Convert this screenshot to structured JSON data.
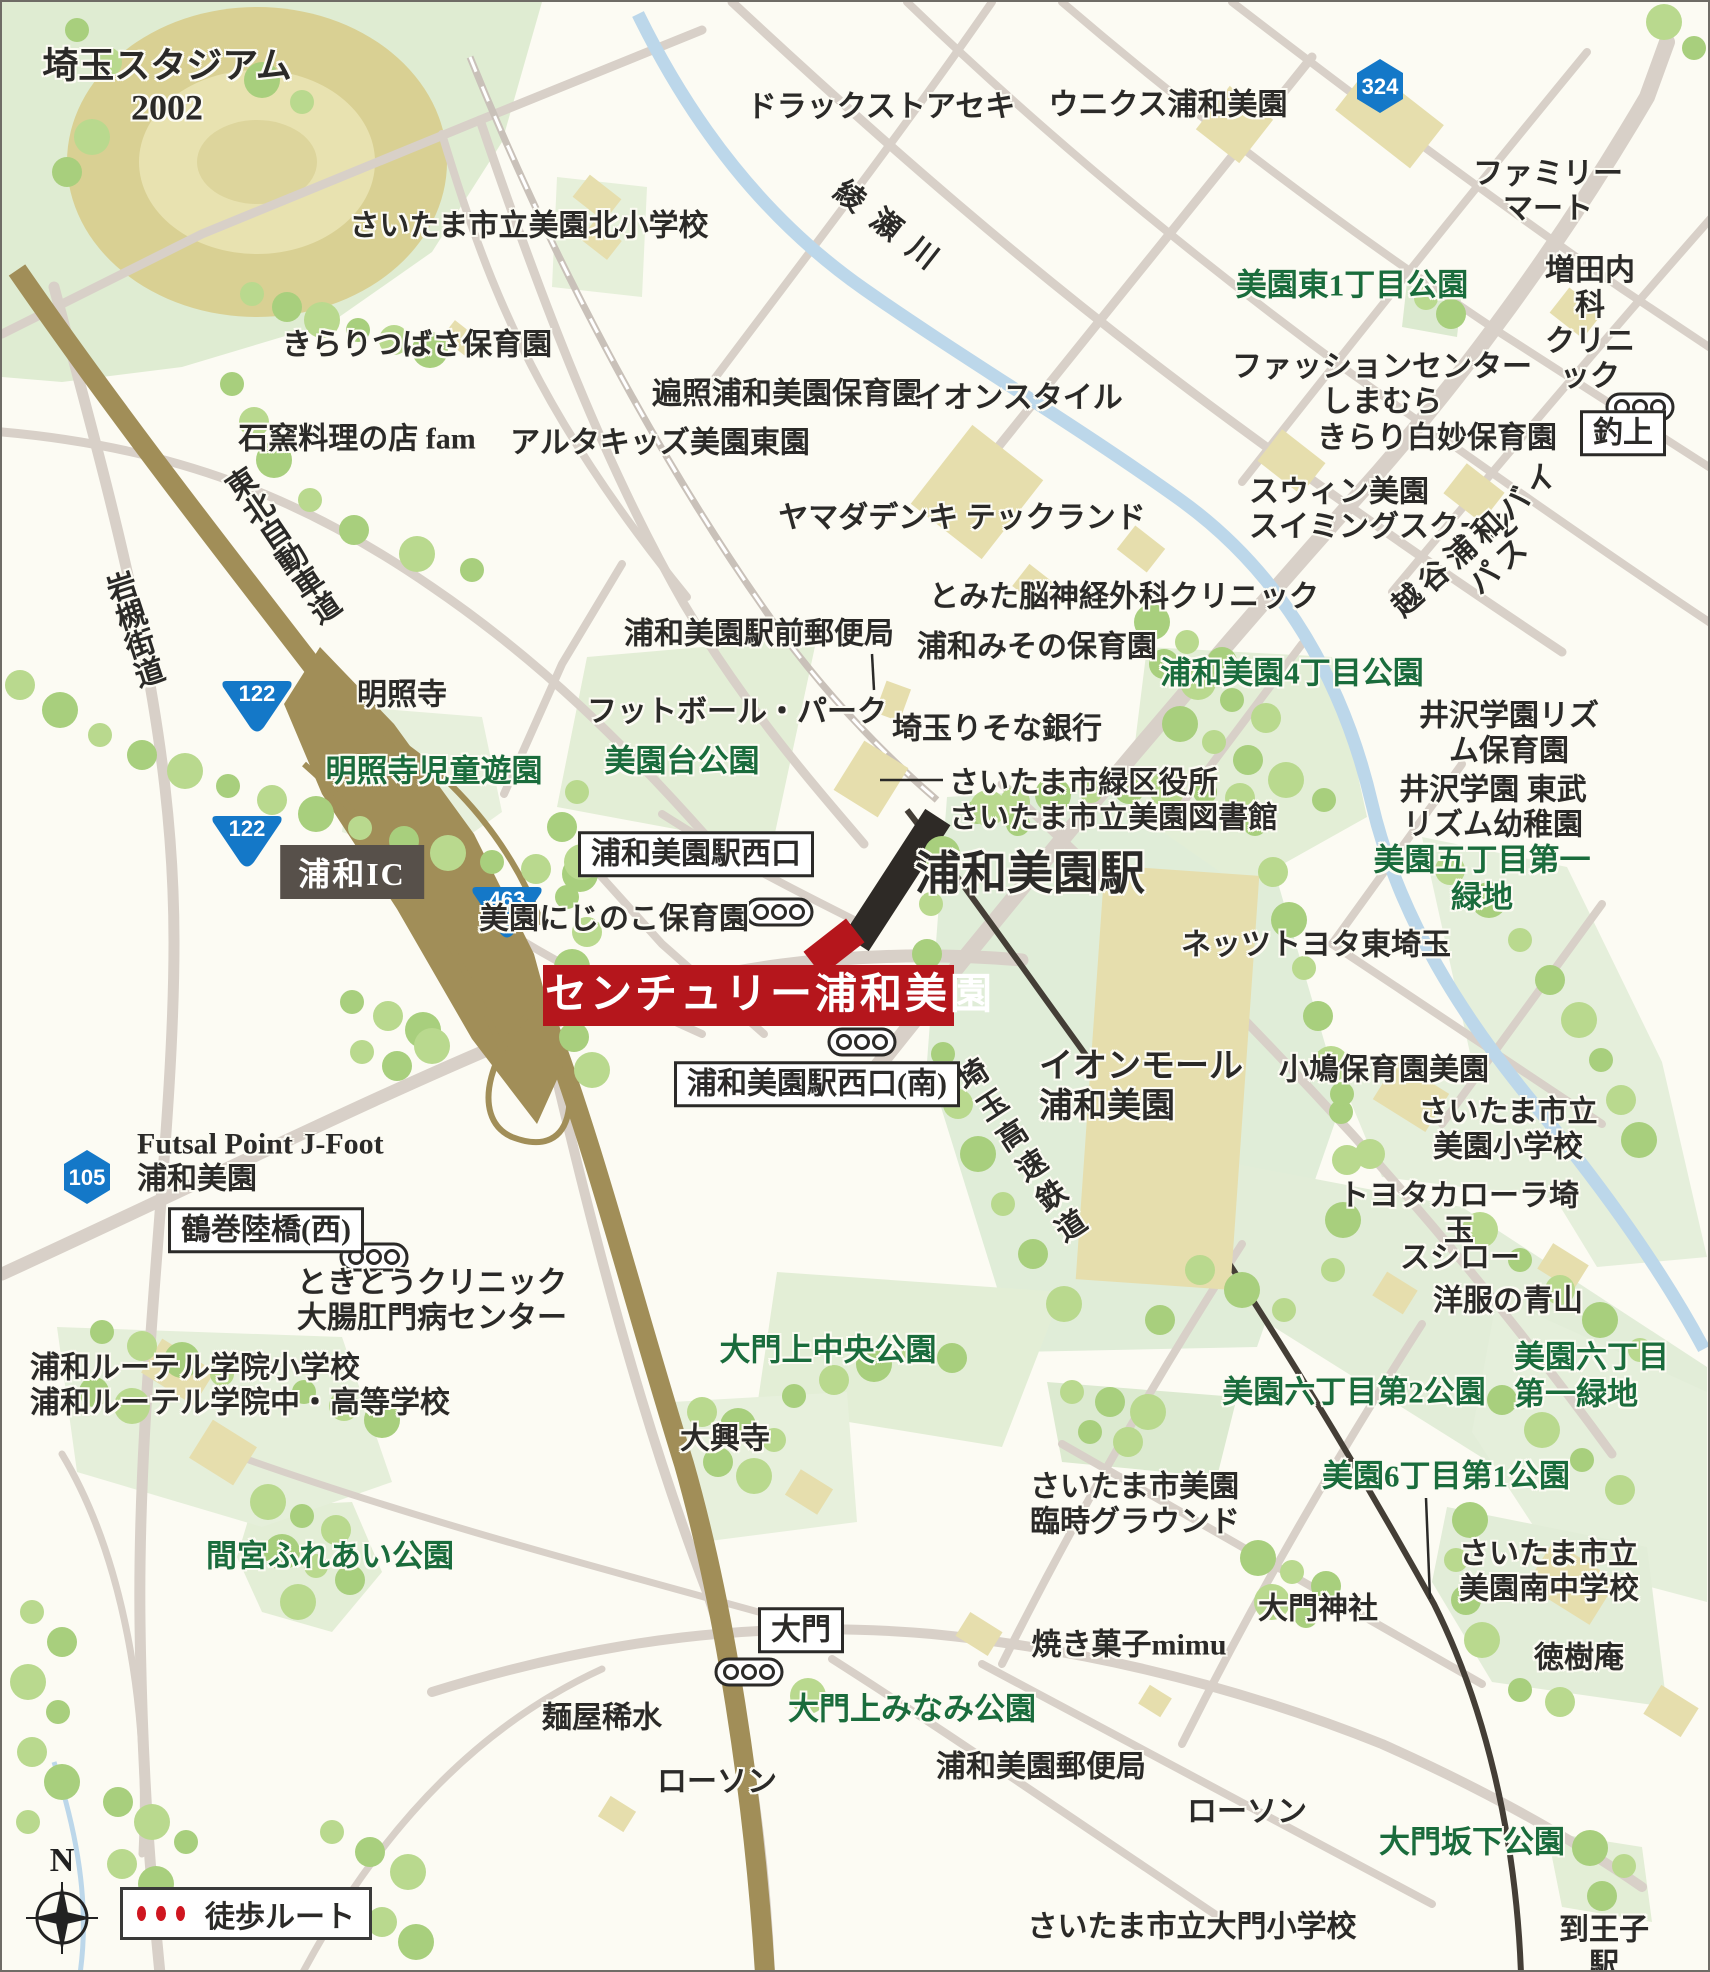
{
  "colors": {
    "accent_red": "#b5161c",
    "park_text_green": "#1a6c3c",
    "shield_blue": "#1478c8",
    "expressway_olive": "#a18e58",
    "river_blue": "#bcd7ea",
    "road_gray": "#d8d0c8",
    "rail_dark": "#443e36"
  },
  "legend": {
    "walk_route": "徒歩ルート",
    "north": "N"
  },
  "property": {
    "banner_label": "センチュリー浦和美園"
  },
  "map": {
    "signposts": [
      {
        "name": "sign-urawamisono-west-exit",
        "text": "浦和美園駅西口",
        "x": 694,
        "y": 852
      },
      {
        "name": "sign-urawamisono-west-exit-south",
        "text": "浦和美園駅西口(南)",
        "x": 815,
        "y": 1082
      },
      {
        "name": "sign-tsurumaki-bridge-west",
        "text": "鶴巻陸橋(西)",
        "x": 264,
        "y": 1228
      },
      {
        "name": "sign-daimon",
        "text": "大門",
        "x": 799,
        "y": 1628
      },
      {
        "name": "sign-tsuriage",
        "text": "釣上",
        "x": 1621,
        "y": 431
      }
    ],
    "ic_label": {
      "text": "浦和IC",
      "x": 350,
      "y": 870
    },
    "route_shields": [
      {
        "num": "122",
        "type": "tri",
        "x": 255,
        "y": 700
      },
      {
        "num": "122",
        "type": "tri",
        "x": 245,
        "y": 835
      },
      {
        "num": "463",
        "type": "tri",
        "x": 505,
        "y": 906
      },
      {
        "num": "324",
        "type": "hex",
        "x": 1378,
        "y": 84
      },
      {
        "num": "105",
        "type": "hex",
        "x": 85,
        "y": 1175
      }
    ],
    "bus_stops": [
      [
        777,
        910
      ],
      [
        860,
        1040
      ],
      [
        1638,
        405
      ],
      [
        372,
        1255
      ],
      [
        747,
        1670
      ]
    ],
    "pointer_lines": [
      [
        870,
        652,
        872,
        688
      ],
      [
        878,
        778,
        941,
        778
      ],
      [
        1424,
        1496,
        1428,
        1597
      ]
    ],
    "labels": [
      {
        "name": "saitama-stadium",
        "text": "埼玉スタジアム\n2002",
        "x": 165,
        "y": 85,
        "s": 36,
        "w": 700
      },
      {
        "name": "misono-kita-elementary",
        "text": "さいたま市立美園北小学校",
        "x": 527,
        "y": 224,
        "s": 30
      },
      {
        "name": "kirari-tsubasa-nursery",
        "text": "きらりつばさ保育園",
        "x": 415,
        "y": 343,
        "s": 30
      },
      {
        "name": "ishigama-fam",
        "text": "石窯料理の店 fam",
        "x": 355,
        "y": 437,
        "s": 30
      },
      {
        "name": "altakids-misono-higashi",
        "text": "アルタキッズ美園東園",
        "x": 658,
        "y": 441,
        "s": 30
      },
      {
        "name": "henjo-urawamisono-nursery",
        "text": "遍照浦和美園保育園",
        "x": 785,
        "y": 392,
        "s": 30
      },
      {
        "name": "drugstore-seki",
        "text": "ドラックストアセキ",
        "x": 879,
        "y": 105,
        "s": 30
      },
      {
        "name": "unicus-urawamisono",
        "text": "ウニクス浦和美園",
        "x": 1166,
        "y": 103,
        "s": 30
      },
      {
        "name": "ayase-river",
        "text": "綾瀬川",
        "x": 890,
        "y": 228,
        "s": 30,
        "rot": 38,
        "spacing": 16
      },
      {
        "name": "familymart",
        "text": "ファミリーマート",
        "x": 1546,
        "y": 190,
        "s": 30
      },
      {
        "name": "misono-higashi-1chome-park",
        "text": "美園東1丁目公園",
        "x": 1350,
        "y": 284,
        "s": 31,
        "c": "green"
      },
      {
        "name": "masuda-naika-clinic",
        "text": "増田内科\nクリニック",
        "x": 1588,
        "y": 322,
        "s": 30
      },
      {
        "name": "fashioncenter-shimamura",
        "text": "ファッションセンターしまむら",
        "x": 1380,
        "y": 383,
        "s": 30
      },
      {
        "name": "kirari-shirotae-nursery",
        "text": "きらり白妙保育園",
        "x": 1435,
        "y": 436,
        "s": 30
      },
      {
        "name": "swin-misono-swimming",
        "text": "スウィン美園\nスイミングスクール",
        "x": 1247,
        "y": 508,
        "s": 30,
        "align": "left"
      },
      {
        "name": "koshigaya-urawa-bypass",
        "text": "越谷浦和バイパス",
        "x": 1487,
        "y": 550,
        "s": 30,
        "rot": -42,
        "spacing": 6
      },
      {
        "name": "yamada-denki-techland",
        "text": "ヤマダデンキ テックランド",
        "x": 960,
        "y": 516,
        "s": 30
      },
      {
        "name": "tomita-neurosurgery-clinic",
        "text": "とみた脳神経外科クリニック",
        "x": 1122,
        "y": 595,
        "s": 30
      },
      {
        "name": "ekimae-post-office",
        "text": "浦和美園駅前郵便局",
        "x": 757,
        "y": 632,
        "s": 30
      },
      {
        "name": "urawa-misono-nursery",
        "text": "浦和みその保育園",
        "x": 1035,
        "y": 645,
        "s": 30
      },
      {
        "name": "urawamisono-4chome-park",
        "text": "浦和美園4丁目公園",
        "x": 1290,
        "y": 672,
        "s": 31,
        "c": "green"
      },
      {
        "name": "izawa-gakuen-rhythm-nursery",
        "text": "井沢学園リズム保育園",
        "x": 1507,
        "y": 732,
        "s": 30
      },
      {
        "name": "izawa-gakuen-tobu-rhythm-kindergarten",
        "text": "井沢学園 東武リズム幼稚園",
        "x": 1491,
        "y": 806,
        "s": 30
      },
      {
        "name": "meishoji-temple",
        "text": "明照寺",
        "x": 400,
        "y": 693,
        "s": 30
      },
      {
        "name": "meishoji-jido-yuen",
        "text": "明照寺児童遊園",
        "x": 432,
        "y": 770,
        "s": 31,
        "c": "green"
      },
      {
        "name": "football-park",
        "text": "フットボール・パーク",
        "x": 735,
        "y": 710,
        "s": 30
      },
      {
        "name": "misonodai-park",
        "text": "美園台公園",
        "x": 680,
        "y": 760,
        "s": 31,
        "c": "green"
      },
      {
        "name": "saitama-resona-bank",
        "text": "埼玉りそな銀行",
        "x": 995,
        "y": 727,
        "s": 30
      },
      {
        "name": "midori-ward-office-library",
        "text": "さいたま市緑区役所\nさいたま市立美園図書館",
        "x": 947,
        "y": 799,
        "s": 30,
        "align": "left"
      },
      {
        "name": "urawa-misono-station",
        "text": "浦和美園駅",
        "x": 1028,
        "y": 872,
        "s": 46,
        "w": 700
      },
      {
        "name": "misono-5chome-ryokuchi",
        "text": "美園五丁目第一緑地",
        "x": 1480,
        "y": 877,
        "s": 31,
        "c": "green"
      },
      {
        "name": "netz-toyota-higashisaitama",
        "text": "ネッツトヨタ東埼玉",
        "x": 1314,
        "y": 943,
        "s": 30
      },
      {
        "name": "misono-nijinoko-nursery",
        "text": "美園にじのこ保育園",
        "x": 612,
        "y": 917,
        "s": 30
      },
      {
        "name": "aeon-mall-urawamisono",
        "text": "イオンモール\n浦和美園",
        "x": 1037,
        "y": 1085,
        "s": 34,
        "align": "left"
      },
      {
        "name": "kobato-nursery-misono",
        "text": "小鳩保育園美園",
        "x": 1382,
        "y": 1068,
        "s": 30
      },
      {
        "name": "misono-elementary",
        "text": "さいたま市立美園小学校",
        "x": 1506,
        "y": 1128,
        "s": 30
      },
      {
        "name": "toyota-corolla-saitama",
        "text": "トヨタカローラ埼玉",
        "x": 1457,
        "y": 1212,
        "s": 30
      },
      {
        "name": "sushiro",
        "text": "スシロー",
        "x": 1458,
        "y": 1256,
        "s": 30
      },
      {
        "name": "yofuku-no-aoyama",
        "text": "洋服の青山",
        "x": 1506,
        "y": 1299,
        "s": 30
      },
      {
        "name": "misono-6chome-daiichi-ryokuchi",
        "text": "美園六丁目\n第一緑地",
        "x": 1512,
        "y": 1374,
        "s": 31,
        "c": "green",
        "align": "left"
      },
      {
        "name": "misono-6chome-dai2-park",
        "text": "美園六丁目第2公園",
        "x": 1352,
        "y": 1391,
        "s": 31,
        "c": "green"
      },
      {
        "name": "misono-6chome-dai1-park",
        "text": "美園6丁目第1公園",
        "x": 1444,
        "y": 1475,
        "s": 31,
        "c": "green"
      },
      {
        "name": "misono-minami-junior-high",
        "text": "さいたま市立\n美園南中学校",
        "x": 1457,
        "y": 1570,
        "s": 30,
        "align": "left"
      },
      {
        "name": "daimon-shrine",
        "text": "大門神社",
        "x": 1316,
        "y": 1607,
        "s": 30
      },
      {
        "name": "tokujuan",
        "text": "徳樹庵",
        "x": 1577,
        "y": 1656,
        "s": 30
      },
      {
        "name": "daimon-sakashita-park",
        "text": "大門坂下公園",
        "x": 1470,
        "y": 1841,
        "s": 31,
        "c": "green"
      },
      {
        "name": "to-oji-station",
        "text": "到王子駅",
        "x": 1602,
        "y": 1946,
        "s": 30
      },
      {
        "name": "daimon-elementary",
        "text": "さいたま市立大門小学校",
        "x": 1190,
        "y": 1925,
        "s": 30
      },
      {
        "name": "lawson-east",
        "text": "ローソン",
        "x": 1245,
        "y": 1810,
        "s": 30
      },
      {
        "name": "urawamisono-post-office",
        "text": "浦和美園郵便局",
        "x": 1039,
        "y": 1765,
        "s": 30
      },
      {
        "name": "yakigashi-mimu",
        "text": "焼き菓子mimu",
        "x": 1127,
        "y": 1643,
        "s": 30
      },
      {
        "name": "misono-rinji-ground",
        "text": "さいたま市美園\n臨時グラウンド",
        "x": 1028,
        "y": 1503,
        "s": 30,
        "align": "left"
      },
      {
        "name": "daimonkami-minami-park",
        "text": "大門上みなみ公園",
        "x": 910,
        "y": 1708,
        "s": 31,
        "c": "green"
      },
      {
        "name": "lawson-west",
        "text": "ローソン",
        "x": 715,
        "y": 1780,
        "s": 30
      },
      {
        "name": "menya-kisui",
        "text": "麺屋稀水",
        "x": 600,
        "y": 1716,
        "s": 30
      },
      {
        "name": "daikoji-temple",
        "text": "大興寺",
        "x": 723,
        "y": 1437,
        "s": 30
      },
      {
        "name": "daimonkami-chuo-park",
        "text": "大門上中央公園",
        "x": 826,
        "y": 1349,
        "s": 31,
        "c": "green"
      },
      {
        "name": "mamiya-fureai-park",
        "text": "間宮ふれあい公園",
        "x": 328,
        "y": 1555,
        "s": 31,
        "c": "green"
      },
      {
        "name": "urawa-lutheran-schools",
        "text": "浦和ルーテル学院小学校\n浦和ルーテル学院中・高等学校",
        "x": 28,
        "y": 1384,
        "s": 30,
        "align": "left"
      },
      {
        "name": "tokito-clinic",
        "text": "ときとうクリニック\n大腸肛門病センター",
        "x": 295,
        "y": 1299,
        "s": 30,
        "align": "left"
      },
      {
        "name": "futsal-point-jfoot",
        "text": "Futsal Point J-Foot\n浦和美園",
        "x": 135,
        "y": 1160,
        "s": 30,
        "align": "left"
      },
      {
        "name": "tohoku-expressway",
        "text": "東北自動車道",
        "x": 278,
        "y": 545,
        "s": 30,
        "rot": -34,
        "vertical": true
      },
      {
        "name": "iwatsuki-kaido",
        "text": "岩槻街道",
        "x": 130,
        "y": 628,
        "s": 30,
        "rot": -18,
        "vertical": true
      },
      {
        "name": "saitama-rapid-railway",
        "text": "埼玉高速鉄道",
        "x": 1018,
        "y": 1152,
        "s": 30,
        "rot": -33,
        "vertical": true,
        "spacing": 6
      },
      {
        "name": "aeon-style",
        "text": "イオンスタイル",
        "x": 1016,
        "y": 396,
        "s": 30
      }
    ]
  }
}
